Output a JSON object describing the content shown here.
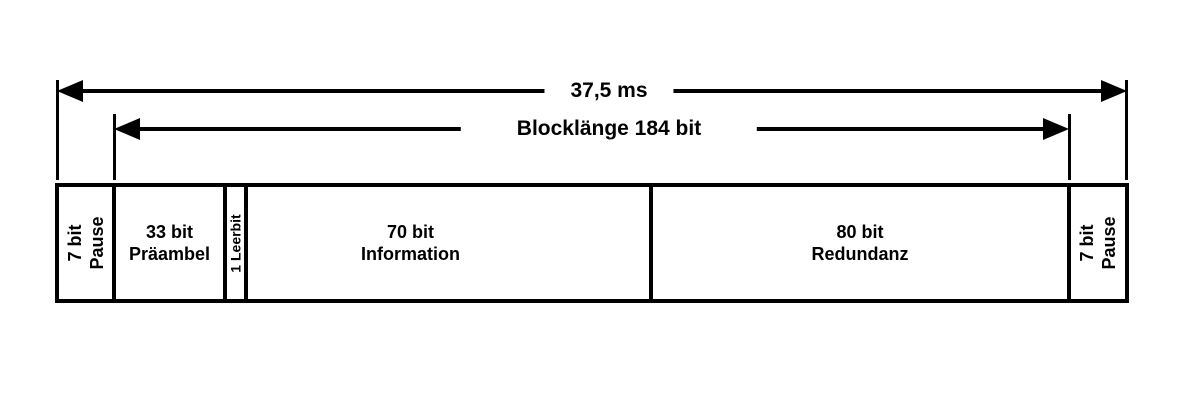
{
  "colors": {
    "background": "#ffffff",
    "ink": "#000000"
  },
  "arrows": {
    "total": {
      "label": "37,5 ms"
    },
    "block": {
      "label": "Blocklänge 184 bit"
    }
  },
  "segments": [
    {
      "name": "pause-left",
      "line1": "7 bit",
      "line2": "Pause",
      "orientation": "vertical"
    },
    {
      "name": "praeambel",
      "line1": "33 bit",
      "line2": "Präambel",
      "orientation": "horizontal"
    },
    {
      "name": "leerbit",
      "line1": "1 Leerbit",
      "orientation": "vertical"
    },
    {
      "name": "information",
      "line1": "70 bit",
      "line2": "Information",
      "orientation": "horizontal"
    },
    {
      "name": "redundanz",
      "line1": "80 bit",
      "line2": "Redundanz",
      "orientation": "horizontal"
    },
    {
      "name": "pause-right",
      "line1": "7 bit",
      "line2": "Pause",
      "orientation": "vertical"
    }
  ]
}
